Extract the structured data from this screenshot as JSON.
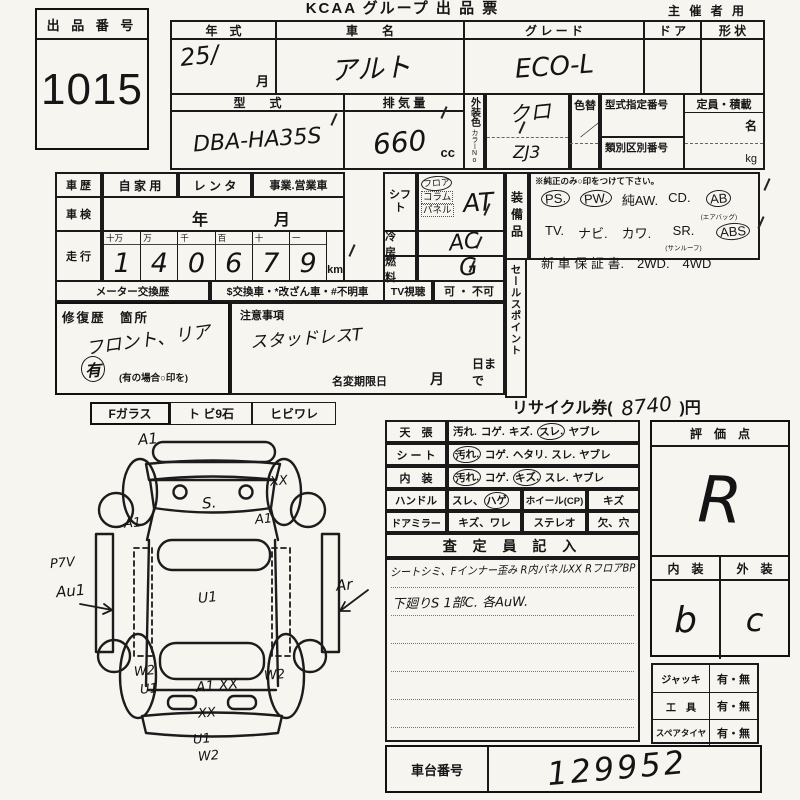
{
  "header": {
    "title": "KCAA グループ 出 品 票",
    "audience": "主 催 者 用"
  },
  "lot": {
    "label": "出 品 番 号",
    "number": "1015"
  },
  "top": {
    "year_label": "年　式",
    "year_value": "25/",
    "month": "月",
    "name_label": "車　　名",
    "name_value": "アルト",
    "grade_label": "グ レ ー ド",
    "grade_value": "ECO-L",
    "door_label": "ド ア",
    "shape_label": "形 状",
    "model_label": "型　　式",
    "model_value": "DBA-HA35S",
    "disp_label": "排 気 量",
    "disp_value": "660",
    "disp_unit": "cc",
    "ext_color_label": "外装色",
    "color_no_label": "カラーNo.",
    "ext_color_value": "クロ",
    "color_no_value": "ZJ3",
    "color_change_label": "色替",
    "color_change_value": "／",
    "type_cert_label": "型式指定番号",
    "class_no_label": "類別区別番号",
    "capacity_label": "定員・積載",
    "capacity_person": "名",
    "capacity_kg": "kg"
  },
  "history": {
    "car_label": "車 歴",
    "opt1": "自 家 用",
    "opt2": "レ ン タ",
    "opt3": "事業.営業車",
    "shaken_label": "車 検",
    "shaken_year": "年",
    "shaken_month": "月",
    "mileage_label": "走 行",
    "digit_units": [
      "十万",
      "万",
      "千",
      "百",
      "十",
      "一"
    ],
    "digits": [
      "1",
      "4",
      "0",
      "6",
      "7",
      "9"
    ],
    "unit": "km",
    "meter_label": "メーター交換歴",
    "meter_opts": "$交換車・*改ざん車・#不明車"
  },
  "controls": {
    "shift_label": "シフト",
    "shift_opts": [
      "フロア",
      "コラム",
      "パネル"
    ],
    "shift_value": "AT",
    "ac_label": "冷　房",
    "ac_value": "AC",
    "fuel_label": "燃　料",
    "fuel_value": "G",
    "tv_label": "TV視聴",
    "tv_opts": "可 ・ 不可"
  },
  "equipment": {
    "label": "装備品",
    "note": "※純正のみ○印をつけて下さい。",
    "row1": [
      "PS.",
      "PW.",
      "純AW.",
      "CD.",
      "AB"
    ],
    "ab_sub": "(エアバッグ)",
    "row2": [
      "TV.",
      "ナビ.",
      "カワ.",
      "SR.",
      "ABS"
    ],
    "sr_sub": "(サンルーフ)",
    "row3": "新 車 保 証 書.　2WD.　4WD"
  },
  "sales_label": "セールスポイント",
  "repair": {
    "label": "修復歴　箇所",
    "value": "フロント、リア",
    "has": "有",
    "note": "(有の場合○印を)"
  },
  "caution": {
    "label": "注意事項",
    "value": "スタッドレスT",
    "rename_label": "名変期限日",
    "month": "月",
    "day": "日まで"
  },
  "recycle": {
    "prefix": "リサイクル券(",
    "amount": "8740",
    "suffix": ")円"
  },
  "glass": {
    "label": "Fガラス",
    "opt1": "ト ビ9石",
    "opt2": "ヒビワレ"
  },
  "diagram": {
    "marks": [
      "A1",
      "XX",
      "S.",
      "A1",
      "A1",
      "P7V",
      "Au1",
      "U1",
      "Ar",
      "W2",
      "U1",
      "A1 XX",
      "W2",
      "XX",
      "U1",
      "W2"
    ]
  },
  "condition": {
    "rows": [
      {
        "label": "天　張",
        "opts": [
          "汚れ.",
          "コゲ.",
          "キズ.",
          "スレ.",
          "ヤブレ"
        ]
      },
      {
        "label": "シ ー ト",
        "opts": [
          "汚れ.",
          "コゲ.",
          "ヘタリ.",
          "スレ.",
          "ヤブレ"
        ]
      },
      {
        "label": "内　装",
        "opts": [
          "汚れ.",
          "コゲ.",
          "キズ.",
          "スレ.",
          "ヤブレ"
        ]
      }
    ],
    "handle_label": "ハンドル",
    "handle_opt_a": "スレ、",
    "handle_opt_b": "ハゲ",
    "wheel_label": "ホイール(CP)",
    "wheel_opt": "キズ",
    "mirror_label": "ドアミラー",
    "mirror_opt": "キズ、ワレ",
    "stereo_label": "ステレオ",
    "stereo_opt": "欠、穴"
  },
  "inspector": {
    "header": "査 定 員 記 入",
    "line1": "シートシミ、Fインナー歪み R内パネルXX RフロアBP",
    "line2": "下廻りS 1部C. 各AuW."
  },
  "rating": {
    "label": "評　価　点",
    "value": "R",
    "interior_label": "内　装",
    "exterior_label": "外　装",
    "interior_value": "b",
    "exterior_value": "c"
  },
  "accessories": [
    {
      "label": "ジャッキ",
      "opts": "有・無"
    },
    {
      "label": "工　具",
      "opts": "有・無"
    },
    {
      "label": "スペアタイヤ",
      "opts": "有・無"
    }
  ],
  "chassis": {
    "label": "車台番号",
    "value": "129952"
  }
}
